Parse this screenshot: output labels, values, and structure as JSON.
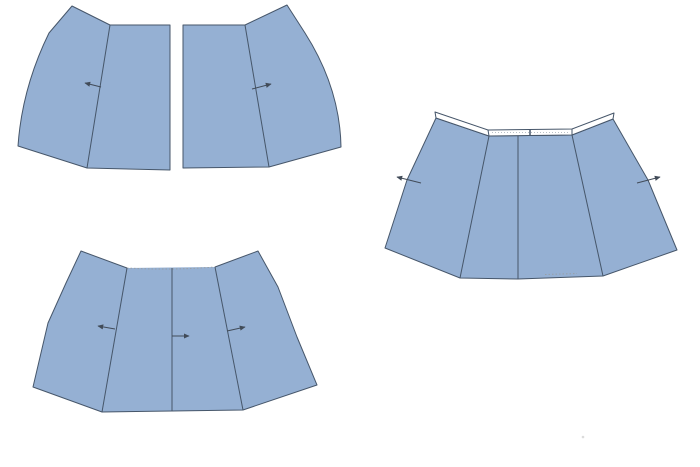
{
  "canvas": {
    "width": 700,
    "height": 467,
    "background": "#ffffff"
  },
  "palette": {
    "piece_fill": "#95b0d3",
    "piece_outline": "#46566a",
    "seam_line": "#46566a",
    "arrow": "#414b58",
    "band_fill": "#ffffff",
    "band_texture": "#b9c0c7",
    "gather_dots": "#98a0a8",
    "artifact": "#dcdcdc"
  },
  "figures": [
    {
      "name": "panels-separated",
      "description": "two mirrored skirt panels spread apart, grain arrows pointing outward",
      "parts": [
        {
          "kind": "shape",
          "name": "left-panel",
          "d": "M 72,6 L 110,25 L 170,25 L 170,170 L 87,168 L 18,146 Q 22,88 49,33 Z",
          "fill": "piece_fill",
          "stroke": "piece_outline"
        },
        {
          "kind": "line",
          "name": "left-panel-seam-line",
          "x1": 110,
          "y1": 25,
          "x2": 87,
          "y2": 168,
          "stroke": "seam_line"
        },
        {
          "kind": "arrow",
          "name": "left-panel-grain-arrow",
          "x1": 101,
          "y1": 87,
          "x2": 85,
          "y2": 83
        },
        {
          "kind": "shape",
          "name": "right-panel",
          "d": "M 287,5 L 245,25 L 183,25 L 183,168 L 269,167 L 341,147 Q 340,88 305,33 Z",
          "fill": "piece_fill",
          "stroke": "piece_outline"
        },
        {
          "kind": "line",
          "name": "right-panel-seam-line",
          "x1": 245,
          "y1": 25,
          "x2": 269,
          "y2": 167,
          "stroke": "seam_line"
        },
        {
          "kind": "arrow",
          "name": "right-panel-grain-arrow",
          "x1": 252,
          "y1": 89,
          "x2": 271,
          "y2": 84
        }
      ]
    },
    {
      "name": "panels-joined",
      "description": "panels joined into one flared piece, gathered dotted top edge, three seam lines with grain arrows",
      "parts": [
        {
          "kind": "shape",
          "name": "joined-piece-fill",
          "d": "M 81,251 L 127,268 L 215,267 L 258,251 L 278,287 L 297,337 L 317,385 L 243,410 L 172,411 L 102,412 L 33,387 L 48,323 L 66,283 Z",
          "fill": "piece_fill"
        },
        {
          "kind": "path",
          "name": "joined-piece-outline",
          "d": "M 215,267 L 258,251 L 278,287 L 297,337 L 317,385 L 243,410 L 172,411 L 102,412 L 33,387 L 48,323 L 66,283 L 81,251 L 127,268",
          "stroke": "piece_outline"
        },
        {
          "kind": "path",
          "name": "gathered-top-edge-dots",
          "d": "M 127,268 Q 171,270.5 215,267",
          "stroke": "gather_dots",
          "dash": "1.5 2"
        },
        {
          "kind": "line",
          "name": "left-seam-line",
          "x1": 127,
          "y1": 268,
          "x2": 102,
          "y2": 412,
          "stroke": "seam_line"
        },
        {
          "kind": "line",
          "name": "center-seam-line",
          "x1": 172,
          "y1": 268,
          "x2": 172,
          "y2": 411,
          "stroke": "seam_line"
        },
        {
          "kind": "line",
          "name": "right-seam-line",
          "x1": 215,
          "y1": 267,
          "x2": 243,
          "y2": 410,
          "stroke": "seam_line"
        },
        {
          "kind": "arrow",
          "name": "left-grain-arrow",
          "x1": 115,
          "y1": 329,
          "x2": 98,
          "y2": 326
        },
        {
          "kind": "arrow",
          "name": "center-grain-arrow",
          "x1": 172,
          "y1": 336,
          "x2": 189,
          "y2": 336
        },
        {
          "kind": "arrow",
          "name": "right-grain-arrow",
          "x1": 227,
          "y1": 331,
          "x2": 245,
          "y2": 327
        }
      ]
    },
    {
      "name": "panels-with-waistband",
      "description": "joined flared piece with white waistband strip attached along top edge, grain arrows crossing side edges",
      "parts": [
        {
          "kind": "shape",
          "name": "skirt-body",
          "d": "M 436,118 L 489,136 L 572,135 L 613,119 L 648,180 L 677,250 L 603,276 L 518,279 L 460,278 L 385,248 L 407,180 Z",
          "fill": "piece_fill",
          "stroke": "piece_outline"
        },
        {
          "kind": "line",
          "name": "left-seam-line",
          "x1": 489,
          "y1": 136,
          "x2": 460,
          "y2": 278,
          "stroke": "seam_line"
        },
        {
          "kind": "line",
          "name": "center-seam-line",
          "x1": 518,
          "y1": 136,
          "x2": 518,
          "y2": 279,
          "stroke": "seam_line"
        },
        {
          "kind": "line",
          "name": "right-seam-line",
          "x1": 572,
          "y1": 135,
          "x2": 603,
          "y2": 276,
          "stroke": "seam_line"
        },
        {
          "kind": "shape",
          "name": "waistband-strip",
          "d": "M 435,112 L 488,130 L 572,129 L 614,113 L 613,119 L 572,135 L 489,136 L 436,118 Z",
          "fill": "band_fill",
          "stroke": "piece_outline"
        },
        {
          "kind": "line",
          "name": "waistband-left-join",
          "x1": 488,
          "y1": 130,
          "x2": 489,
          "y2": 136,
          "stroke": "piece_outline"
        },
        {
          "kind": "line",
          "name": "waistband-right-join",
          "x1": 572,
          "y1": 129,
          "x2": 572,
          "y2": 135,
          "stroke": "piece_outline"
        },
        {
          "kind": "line",
          "name": "waistband-center-notch",
          "x1": 530,
          "y1": 129,
          "x2": 530,
          "y2": 135.5,
          "stroke": "piece_outline",
          "width": 1.5
        },
        {
          "kind": "path",
          "name": "waistband-stitch-dots",
          "d": "M 492,132.5 L 569,132.5",
          "stroke": "band_texture",
          "dash": "1 2"
        },
        {
          "kind": "path",
          "name": "hem-stitch-dots",
          "d": "M 545,274.5 L 577,273.5",
          "stroke": "gather_dots",
          "dash": "1.5 2"
        },
        {
          "kind": "arrow",
          "name": "left-grain-arrow",
          "x1": 421,
          "y1": 183,
          "x2": 397,
          "y2": 177
        },
        {
          "kind": "arrow",
          "name": "right-grain-arrow",
          "x1": 637,
          "y1": 183,
          "x2": 660,
          "y2": 177
        }
      ]
    }
  ],
  "artifact_dot": {
    "x": 583,
    "y": 437,
    "r": 1.3
  }
}
